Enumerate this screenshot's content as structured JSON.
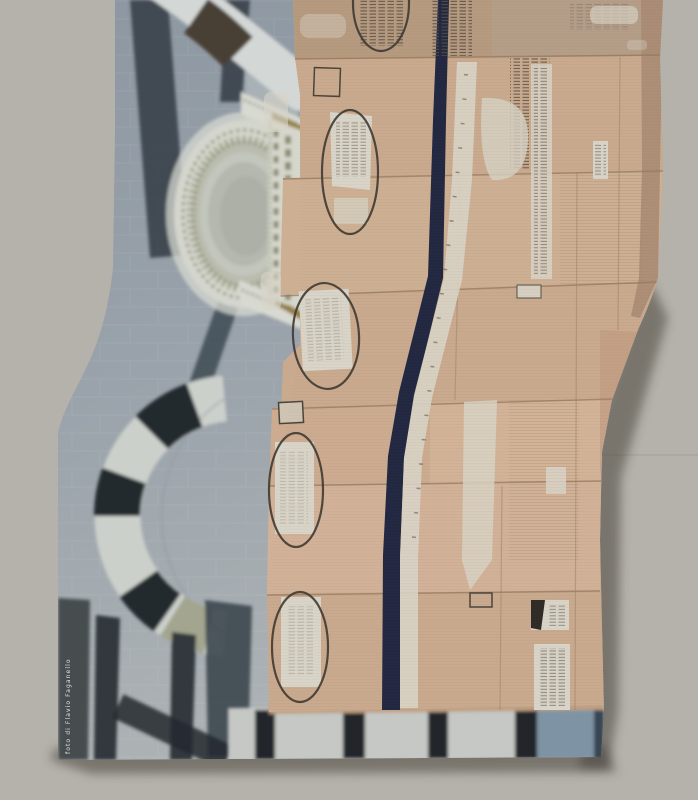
{
  "artwork": {
    "caption": "foto di Flavio Faganello",
    "scene": "collage poster: striped marble architecture photograph on the left, stacked cardboard boxes with printed ovals, tape strips and a dark navy stripe on the right, marble colonnade strip at the bottom, on a plain warm-grey background"
  },
  "colors": {
    "bg": "#b5b2ab",
    "marble": "#9aa3ab",
    "marble_dark": "#8d97a1",
    "marble_light": "#aeb3b5",
    "marble_white": "#d3d7d6",
    "stripe_dark": "#3a434c",
    "pediment_cream": "#d8d9d1",
    "olive": "#8e8e74",
    "gold": "#9a8040",
    "cardboard": "#c9aa8e",
    "cardboard_light": "#d2b49a",
    "cardboard_dark": "#b69a80",
    "navy_stripe": "#222841",
    "label_white": "#d8d4c7",
    "bottom_bar_black": "#22262a",
    "bottom_blue": "#7e93a3",
    "caption_color": "#e6e6e2"
  }
}
